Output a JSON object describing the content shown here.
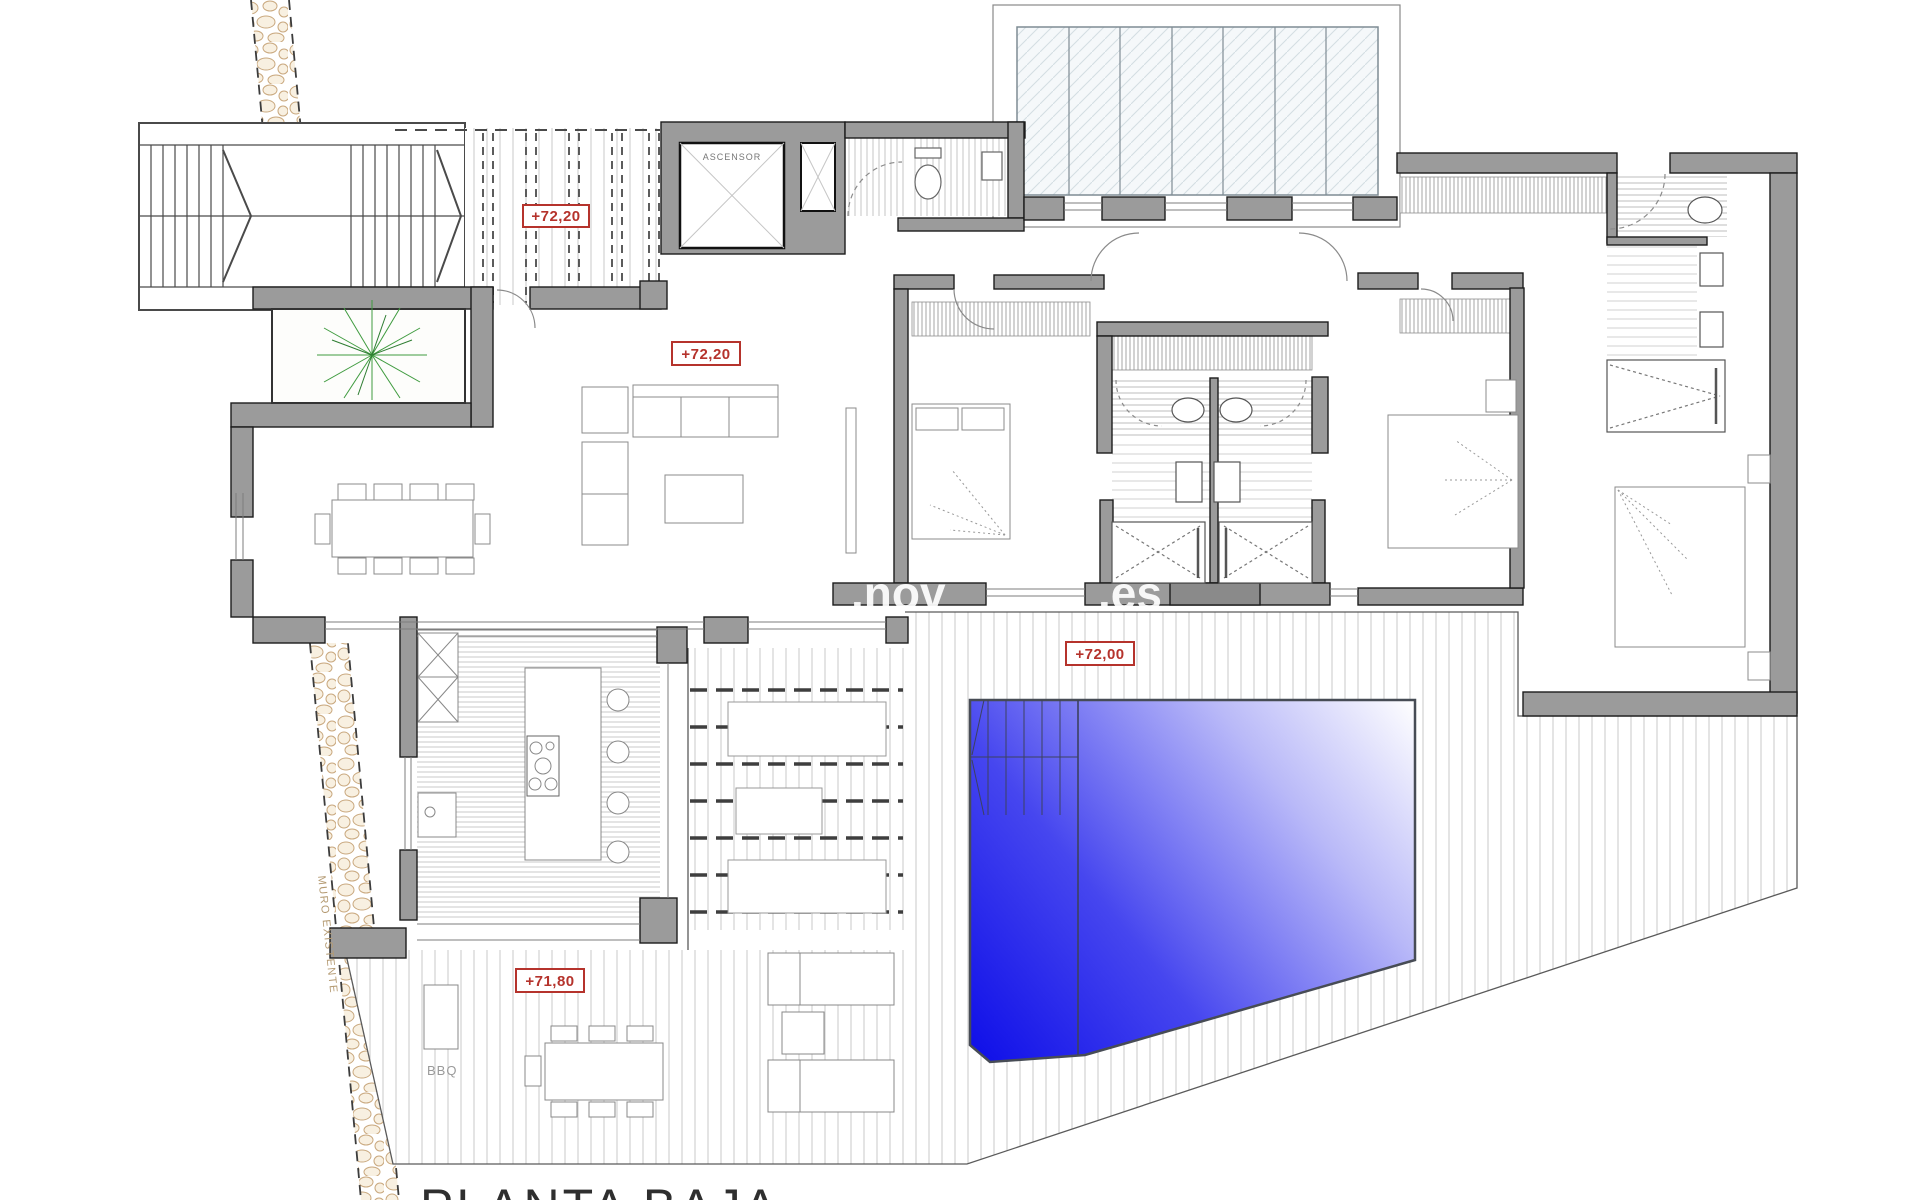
{
  "plan": {
    "title": "PLANTA BAJA",
    "elevator_label": "ASCENSOR",
    "existing_wall_label": "MURO EXISTENTE",
    "bbq_label": "BBQ",
    "markers": [
      {
        "name": "entry-porch",
        "text": "+72,20"
      },
      {
        "name": "living-room",
        "text": "+72,20"
      },
      {
        "name": "pool-deck",
        "text": "+72,00"
      },
      {
        "name": "lower-terrace",
        "text": "+71,80"
      }
    ],
    "watermark": {
      "left": ".nov",
      "right": ".es"
    },
    "colors": {
      "wall_gray": "#9b9b9b",
      "marker_red": "#b5332c",
      "pool_blue": "#1414ef",
      "deck_line": "#c8c8c8",
      "pebble_tan": "#c9a87e",
      "plant_green": "#3f9b3f"
    }
  }
}
